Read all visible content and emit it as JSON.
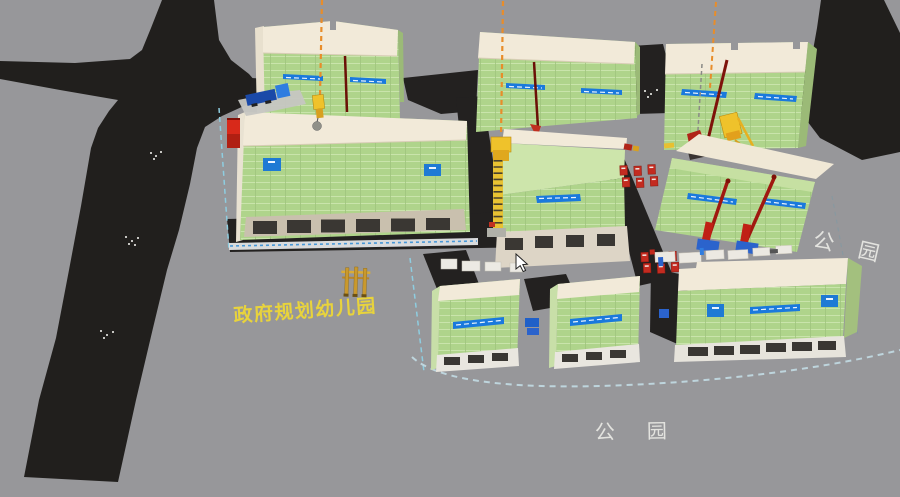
{
  "scene": {
    "view_title": "3d-construction-site-viewport",
    "ground_labels": {
      "kindergarten": "政府规划幼儿园",
      "park_right": "公　园",
      "park_bottom": "公　园"
    },
    "objects": {
      "buildings_under_construction": 9,
      "tower_cranes": 3,
      "pile_drivers": 2,
      "site_trucks": 1,
      "fire_extinguisher_stations": 2
    },
    "colors": {
      "ground": "#97979a",
      "road": "#211f1d",
      "scaffold_green": "#afd48b",
      "scaffold_green_light": "#c6e0a2",
      "parapet_cream": "#f2ead9",
      "base_tan": "#d8d0c1",
      "banner_blue": "#1a79dd",
      "crane_yellow": "#efc22b",
      "crane_orange": "#e88d2a",
      "machine_red": "#bb2415",
      "machine_base_blue": "#2b63cc",
      "boundary_dash": "#9fd8ea",
      "label_yellow": "#e8d33c",
      "label_white": "#e3e3df"
    }
  }
}
